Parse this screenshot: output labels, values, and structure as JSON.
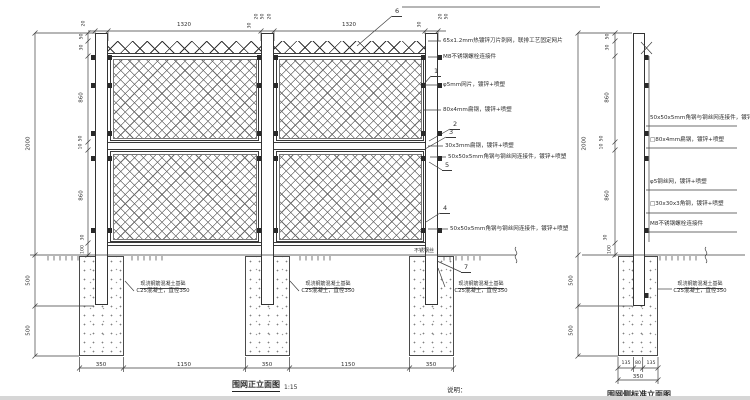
{
  "front": {
    "title": "围网正立面图",
    "scale": "1:15",
    "balloons": {
      "b1": "1",
      "b2": "2",
      "b3": "3",
      "b4": "4",
      "b5": "5",
      "b6": "6",
      "b7": "7"
    },
    "labels": {
      "razor": "65x1.2mm热镀锌刀片刺网，联排工艺固定网片",
      "bolt": "M8不锈钢螺栓连接件",
      "mesh": "φ5mm网片，镀锌+喷塑",
      "flat80": "80x4mm扁钢，镀锌+喷塑",
      "flat30": "30x3mm扁钢，镀锌+喷塑",
      "angle_mid": "50x50x5mm角钢与钢丝网连接件，镀锌+喷塑",
      "angle_bottom": "50x50x5mm角钢与钢丝网连接件，镀锌+喷塑",
      "wire": "不锈钢丝",
      "foundation1": "现浇钢筋混凝土基础",
      "foundation2": "C25混凝土，直径350"
    },
    "dims": {
      "total": "2000",
      "top": [
        "20",
        "1320",
        "30",
        "20",
        "50",
        "20",
        "1320",
        "30",
        "20",
        "50"
      ],
      "chain": [
        "50",
        "30",
        "860",
        "50",
        "10",
        "860",
        "30",
        "100"
      ],
      "below": [
        "500",
        "500"
      ],
      "bottom": [
        "350",
        "1150",
        "350",
        "1150",
        "350"
      ]
    }
  },
  "side": {
    "title": "围网侧标准立面图",
    "labels": {
      "angle_top": "50x50x5mm角钢与钢丝网连接件，镀锌+喷塑",
      "flat80": "□80x4mm扁钢，镀锌+喷塑",
      "mesh": "φ5钢丝网，镀锌+喷塑",
      "angle30": "□30x30x3角钢，镀锌+喷塑",
      "bolt": "M8不锈钢螺栓连接件",
      "foundation1": "现浇钢筋混凝土基础",
      "foundation2": "C25混凝土，直径350"
    },
    "dims": {
      "total": "2000",
      "chain": [
        "50",
        "30",
        "860",
        "50",
        "10",
        "860",
        "30",
        "100"
      ],
      "below": [
        "500",
        "500"
      ],
      "bottom_row": [
        "135",
        "80",
        "135"
      ],
      "bottom_total": "350"
    }
  },
  "notes": "说明："
}
